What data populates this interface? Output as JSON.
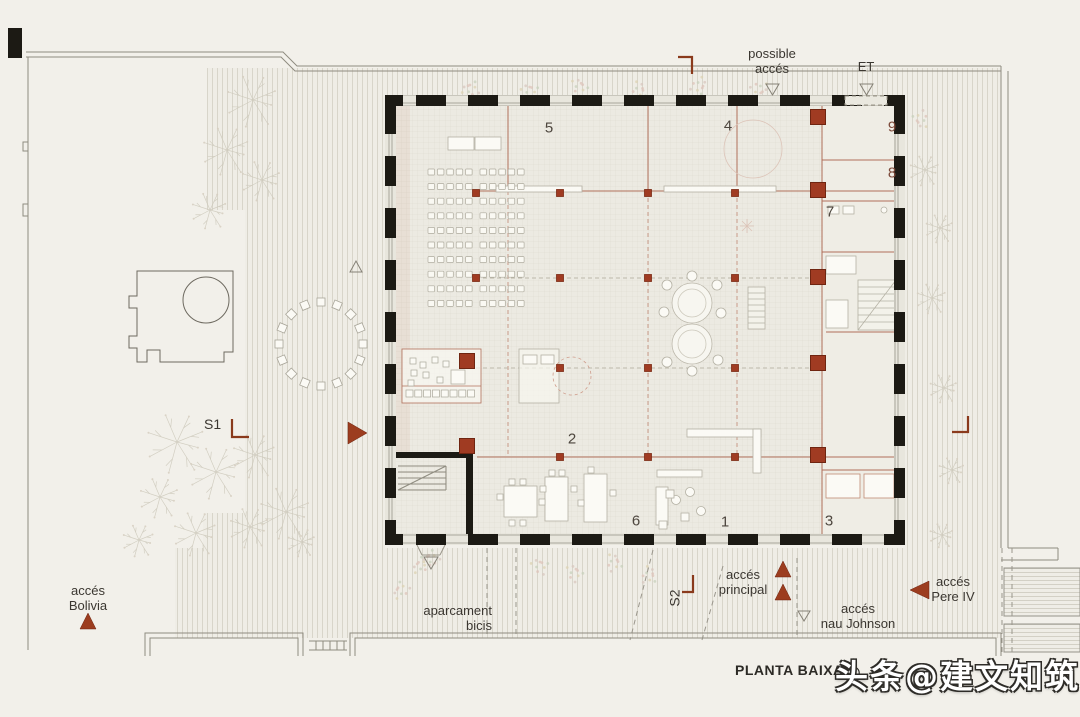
{
  "plan": {
    "title": "PLANTA BAIXA",
    "watermark": "头条@建文知筑",
    "colors": {
      "accent": "#9c3d1f",
      "wall": "#1c1a14",
      "ink": "#3b3731",
      "partition": "#b1705a"
    },
    "labels": {
      "possible_acces": {
        "line1": "possible",
        "line2": "accés"
      },
      "et": "ET",
      "s1": "S1",
      "s2": "S2",
      "acces_bolivia": {
        "line1": "accés",
        "line2": "Bolivia"
      },
      "aparcament_bicis": {
        "line1": "aparcament",
        "line2": "bicis"
      },
      "acces_principal": {
        "line1": "accés",
        "line2": "principal"
      },
      "acces_nau_johnson": {
        "line1": "accés",
        "line2": "nau Johnson"
      },
      "acces_pere_iv": {
        "line1": "accés",
        "line2": "Pere IV"
      }
    },
    "rooms": [
      {
        "label": "5",
        "x": 549,
        "y": 128,
        "color": "#4d463e"
      },
      {
        "label": "4",
        "x": 728,
        "y": 126,
        "color": "#4d463e"
      },
      {
        "label": "9",
        "x": 892,
        "y": 127,
        "color": "#7d4a3a"
      },
      {
        "label": "8",
        "x": 892,
        "y": 173,
        "color": "#7d4a3a"
      },
      {
        "label": "7",
        "x": 830,
        "y": 212,
        "color": "#4d463e"
      },
      {
        "label": "2",
        "x": 572,
        "y": 439,
        "color": "#4d463e"
      },
      {
        "label": "6",
        "x": 636,
        "y": 521,
        "color": "#4d463e"
      },
      {
        "label": "1",
        "x": 725,
        "y": 522,
        "color": "#4d463e"
      },
      {
        "label": "3",
        "x": 829,
        "y": 521,
        "color": "#4d463e"
      }
    ]
  }
}
